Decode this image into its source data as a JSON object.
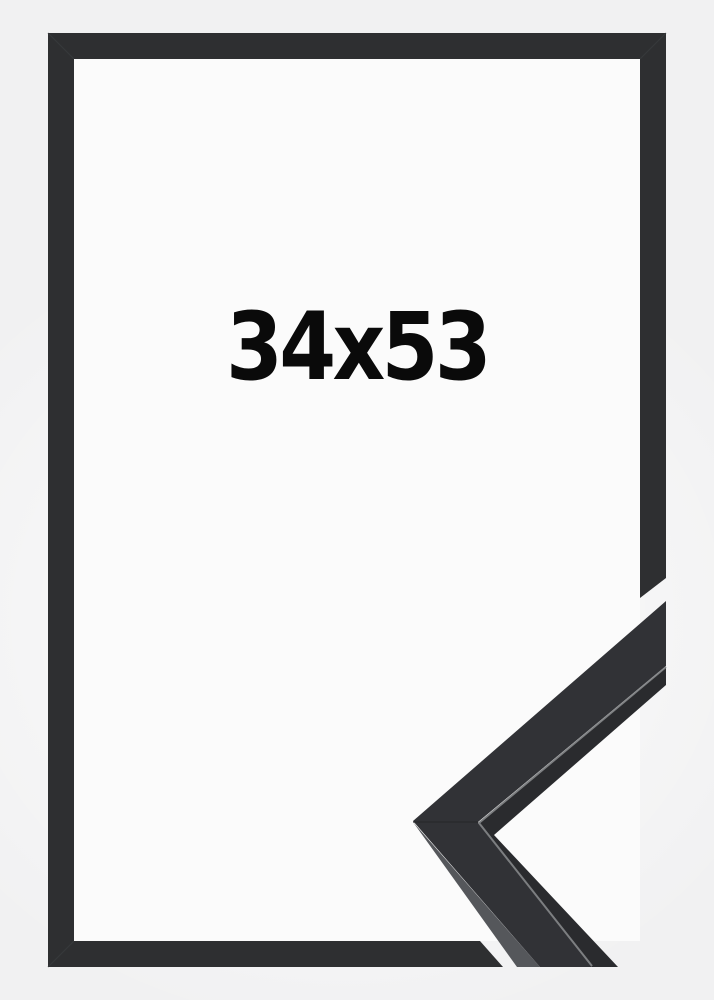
{
  "image": {
    "size_label": "34x53"
  },
  "colors": {
    "background": "#f1f1f2",
    "inside": "#fbfbfb",
    "frame": "#2e2f31",
    "frame_seam": "#3a3b3e",
    "piece_face": "#313236",
    "piece_side_light": "#55575b",
    "piece_side_dark": "#2a2b2e",
    "piece_highlight": "#85878a",
    "piece_seam": "#26272a",
    "label_text": "#0a0a0a"
  }
}
